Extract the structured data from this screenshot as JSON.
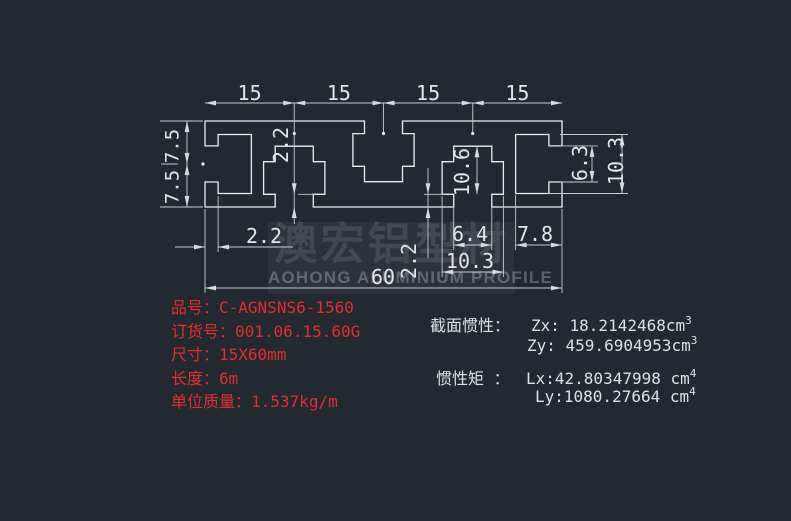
{
  "colors": {
    "background": "#232931",
    "line": "#eaedf0",
    "dimension": "#c7ccd2",
    "product_text": "#e62e2e",
    "inertia_text": "#dde1e4"
  },
  "dims": {
    "top": [
      "15",
      "15",
      "15",
      "15"
    ],
    "left": [
      "7.5",
      "7.5"
    ],
    "slot1_neck": "2.2",
    "wall": "2.2",
    "slot2_neck": "2.2",
    "slot_depth": "10.6",
    "mouth_width": "6.4",
    "cavity_width": "10.3",
    "end_slot_depth": "7.8",
    "overall_width": "60",
    "end_mouth_height": "6.3",
    "end_cavity_height": "10.3"
  },
  "product": {
    "fields": [
      {
        "label": "品号：",
        "value": "C-AGNSNS6-1560"
      },
      {
        "label": "订货号：",
        "value": "001.06.15.60G"
      },
      {
        "label": "尺寸：",
        "value": "15X60mm"
      },
      {
        "label": "长度：",
        "value": "6m"
      },
      {
        "label": "单位质量：",
        "value": "1.537kg/m"
      }
    ]
  },
  "inertia": {
    "section_title": "截面惯性：",
    "zx_value": "Zx: 18.2142468cm",
    "zx_sup": "3",
    "zy_value": "Zy: 459.6904953cm",
    "zy_sup": "3",
    "moment_title": "惯性矩 ：",
    "lx_value": "Lx:42.80347998 cm",
    "lx_sup": "4",
    "ly_value": "Ly:1080.27664 cm",
    "ly_sup": "4"
  },
  "watermark": {
    "cn": "澳宏铝型材",
    "en": "AOHONG ALUMINIUM PROFILE"
  }
}
